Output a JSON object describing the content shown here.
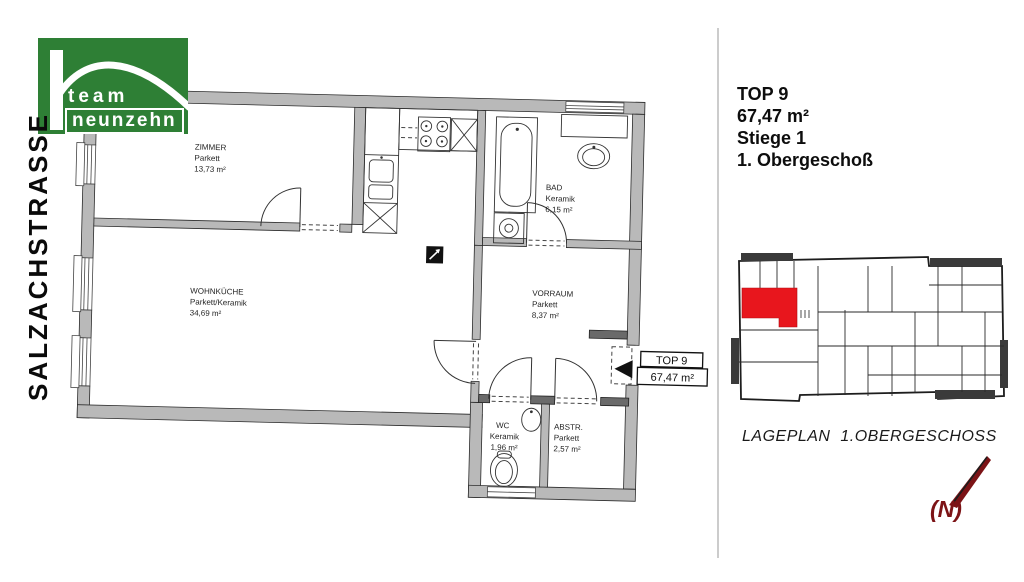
{
  "colors": {
    "brand_green": "#2e7f35",
    "highlight_red": "#e8161d",
    "north_red": "#7c1316",
    "wall_gray": "#b9b9b9"
  },
  "logo": {
    "line1": "team",
    "line2": "neunzehn"
  },
  "street_label": "SALZACHSTRASSE",
  "floorplan": {
    "rooms": [
      {
        "name": "ZIMMER",
        "material": "Parkett",
        "area": "13,73 m²"
      },
      {
        "name": "WOHNKÜCHE",
        "material": "Parkett/Keramik",
        "area": "34,69 m²"
      },
      {
        "name": "BAD",
        "material": "Keramik",
        "area": "6,15 m²"
      },
      {
        "name": "VORRAUM",
        "material": "Parkett",
        "area": "8,37 m²"
      },
      {
        "name": "WC",
        "material": "Keramik",
        "area": "1,96 m²"
      },
      {
        "name": "ABSTR.",
        "material": "Parkett",
        "area": "2,57 m²"
      }
    ],
    "entry_tag": {
      "line1": "TOP 9",
      "line2": "67,47 m²"
    }
  },
  "info_panel": {
    "lines": [
      "TOP 9",
      "67,47 m²",
      "Stiege 1",
      "1. Obergeschoß"
    ]
  },
  "siteplan": {
    "caption": "LAGEPLAN  1.OBERGESCHOSS",
    "north_label": "(N)"
  }
}
